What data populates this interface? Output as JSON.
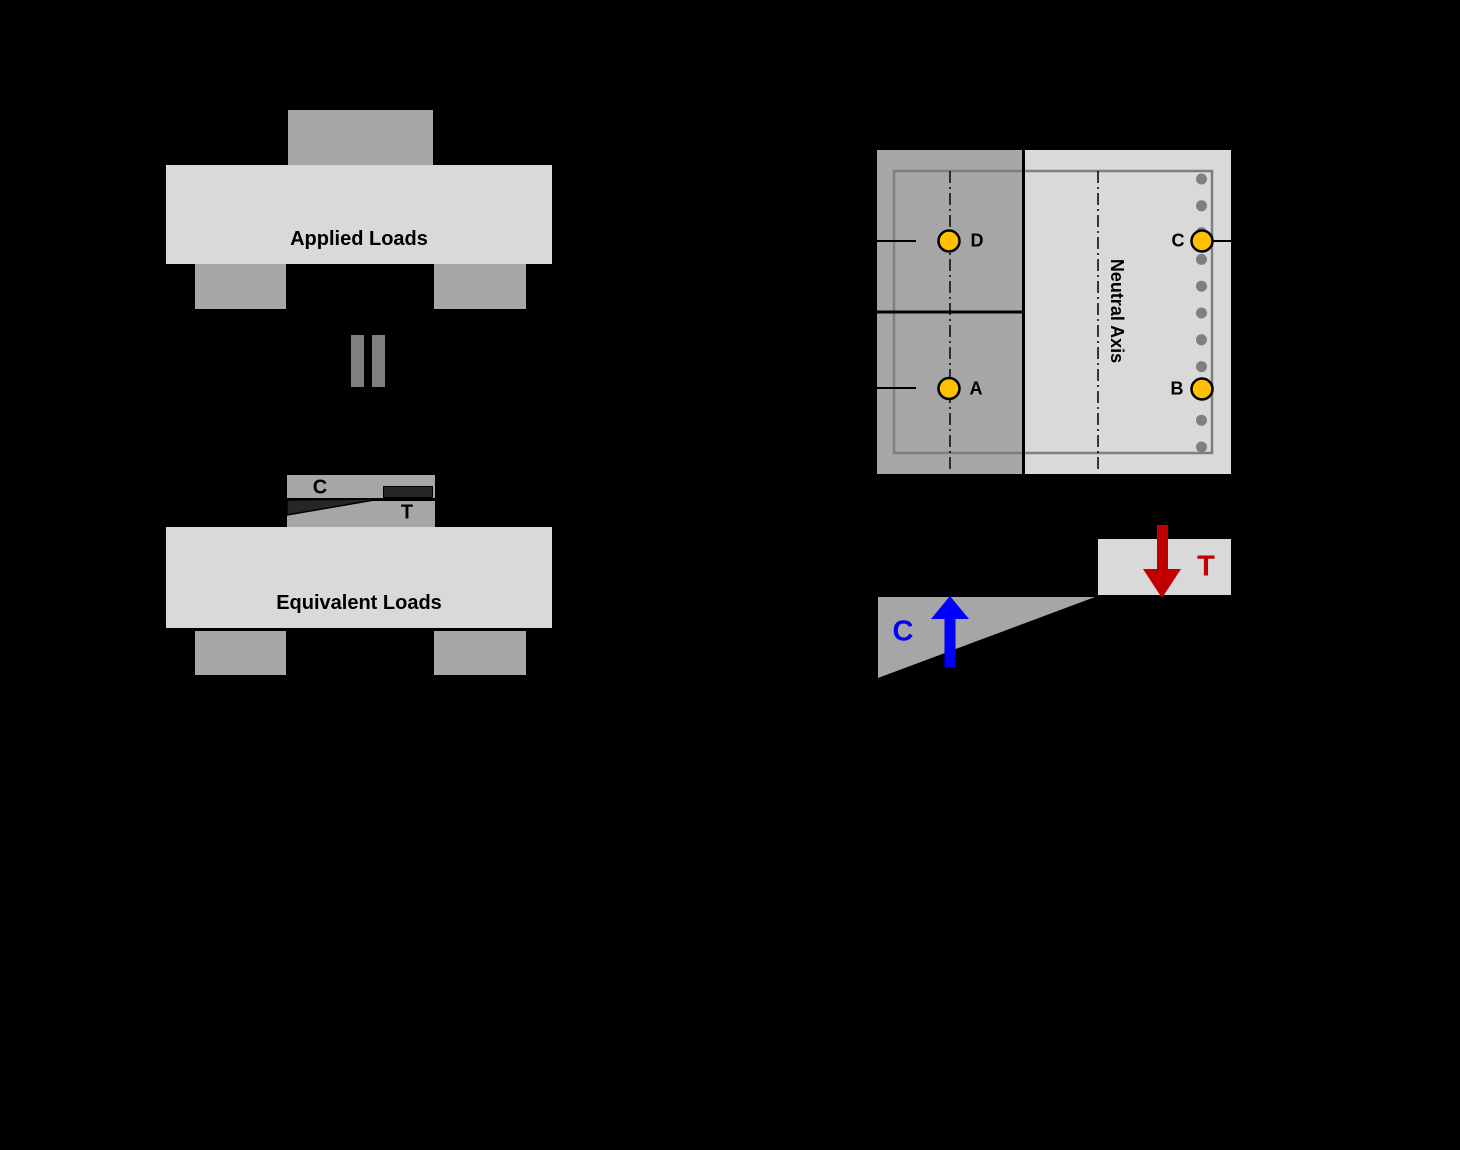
{
  "figure": {
    "description": "Four-point bending load diagram with equivalent internal force couple and instrumented cross-section"
  },
  "applied": {
    "beam_label": "Applied Loads"
  },
  "equivalent": {
    "beam_label": "Equivalent Loads"
  },
  "equals_sign": {
    "meaning": "="
  },
  "crack_detail": {
    "compression_label": "C",
    "tension_label": "T"
  },
  "cross_section": {
    "neutral_axis_label": "Neutral Axis",
    "gauge_d_label": "D",
    "gauge_a_label": "A",
    "gauge_c_label": "C",
    "gauge_b_label": "B"
  },
  "force_couple": {
    "compression_label": "C",
    "tension_label": "T"
  },
  "colors": {
    "background": "#000000",
    "beam_light_gray": "#d9d9d9",
    "block_mid_gray": "#a6a6a6",
    "detail_dark_gray": "#262626",
    "line_gray": "#7f7f7f",
    "gauge_yellow": "#ffc000",
    "tension_red": "#c00000",
    "compression_blue": "#0000ff"
  }
}
